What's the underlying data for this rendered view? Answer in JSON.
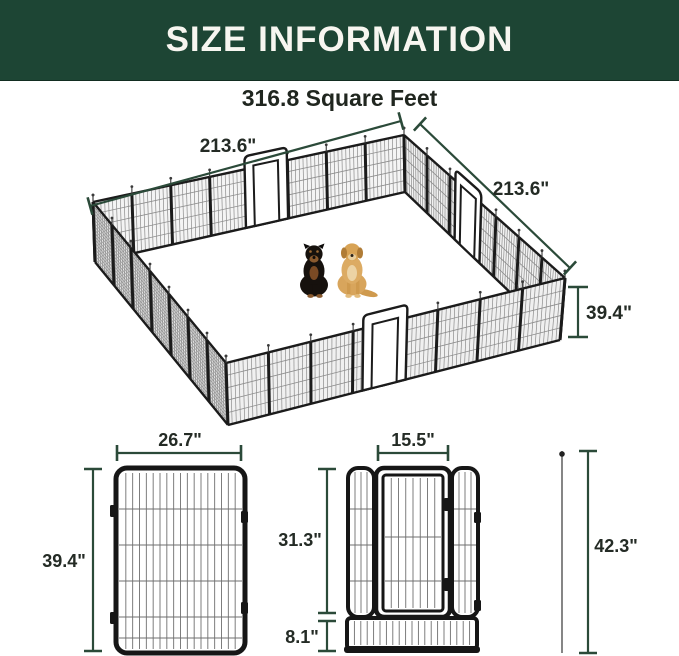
{
  "header": {
    "title": "SIZE INFORMATION"
  },
  "subtitle": "316.8 Square Feet",
  "pen": {
    "dims": {
      "top_edge": "213.6\"",
      "right_edge": "213.6\"",
      "panel_height": "39.4\""
    },
    "dogs": [
      "rottweiler",
      "golden retriever"
    ]
  },
  "panel_detail": {
    "width": "26.7\"",
    "height": "39.4\""
  },
  "door_panel_detail": {
    "door_width": "15.5\"",
    "door_height": "31.3\"",
    "bottom_height": "8.1\"",
    "total_height": "42.3\""
  },
  "colors": {
    "header_bg": "#1d4534",
    "header_text": "#f7f6f0",
    "dim_line": "#2b4a39",
    "dim_label": "#242b25",
    "fence_frame": "#1b1b1b",
    "fence_mesh": "#8c8c8c"
  }
}
